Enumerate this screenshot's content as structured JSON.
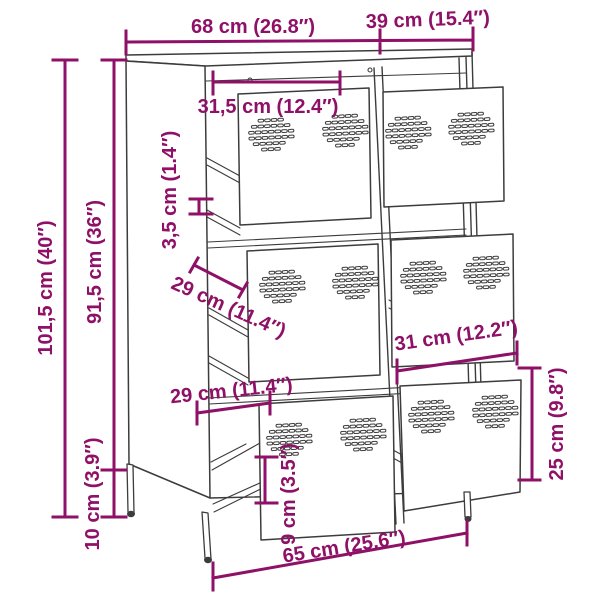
{
  "diagram": {
    "kind": "furniture dimension drawing",
    "object": "6-drawer steel cabinet with ventilation holes"
  },
  "dimensions": {
    "top_width": "68 cm (26.8″)",
    "top_depth": "39 cm (15.4″)",
    "total_height": "101,5 cm (40″)",
    "body_height": "91,5 cm (36″)",
    "leg_height": "10 cm (3.9″)",
    "drawer_width_left": "31,5 cm (12.4″)",
    "shelf_gap": "3,5 cm (1.4″)",
    "drawer_depth_middle": "29 cm (11.4″)",
    "drawer_width_right": "31 cm (12.2″)",
    "drawer_depth_bottom": "29 cm (11.4″)",
    "drawer_inner_height": "9 cm (3.5″)",
    "drawer_front_height": "25 cm (9.8″)",
    "base_width": "65 cm (25.6″)"
  },
  "colors": {
    "dimension_accent": "#8E1067",
    "outline": "#3C3C3C",
    "background": "#FFFFFF"
  }
}
